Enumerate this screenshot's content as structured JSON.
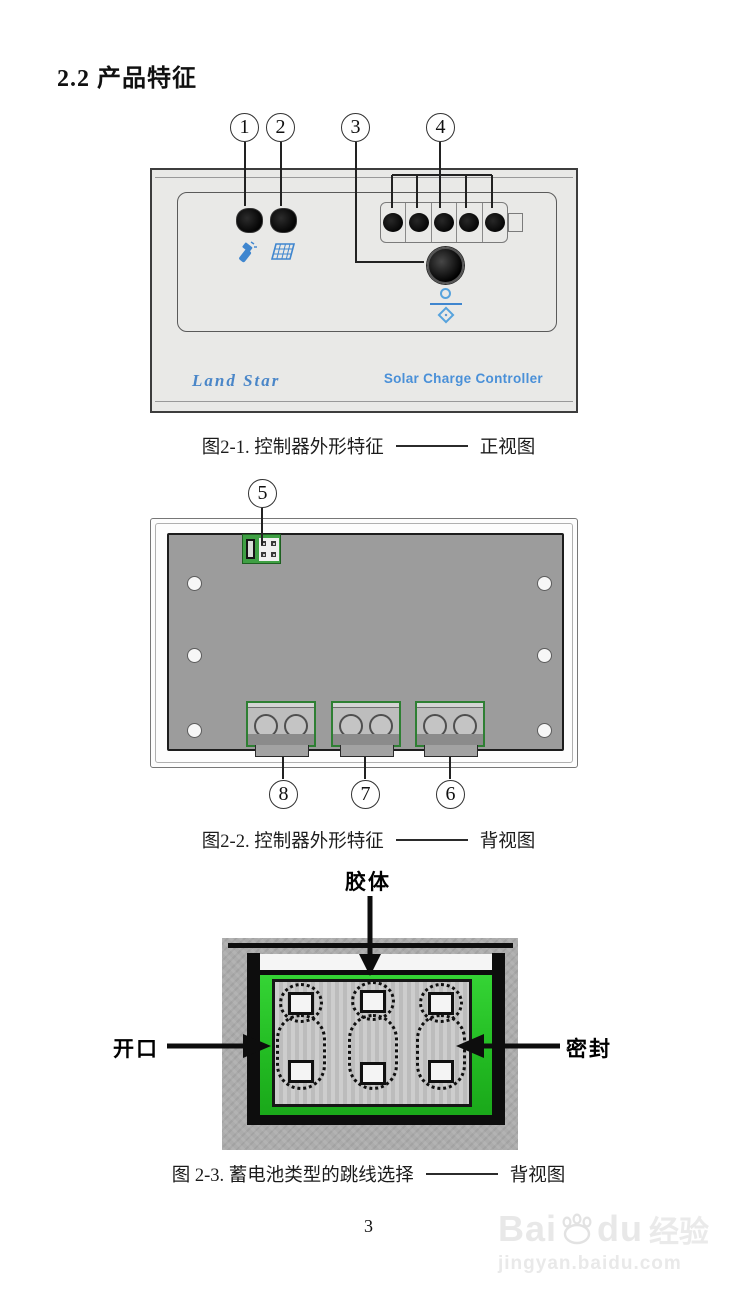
{
  "page": {
    "title": "2.2 产品特征",
    "page_number": "3"
  },
  "figure1": {
    "callouts": [
      "1",
      "2",
      "3",
      "4"
    ],
    "brand": "Land Star",
    "product_name": "Solar Charge Controller",
    "caption_prefix": "图2-1. 控制器外形特征",
    "caption_suffix": "正视图",
    "icons": [
      "lamp-indicator-icon",
      "solar-panel-icon",
      "battery-type-icon"
    ]
  },
  "figure2": {
    "callout_jumper": "5",
    "callouts_bottom": [
      "8",
      "7",
      "6"
    ],
    "caption_prefix": "图2-2. 控制器外形特征",
    "caption_suffix": "背视图"
  },
  "figure3": {
    "label_gel": "胶体",
    "label_open": "开口",
    "label_sealed": "密封",
    "caption_prefix": "图 2-3. 蓄电池类型的跳线选择",
    "caption_suffix": "背视图"
  },
  "watermark": {
    "bai": "Bai",
    "du": "du",
    "cn": "经验",
    "url": "jingyan.baidu.com"
  },
  "colors": {
    "accent_blue": "#4a90d8",
    "brand_blue": "#4a86c8",
    "pcb_green": "#2ecc2e",
    "jumper_green": "#3fa044",
    "panel_gray": "#9c9c9c"
  }
}
